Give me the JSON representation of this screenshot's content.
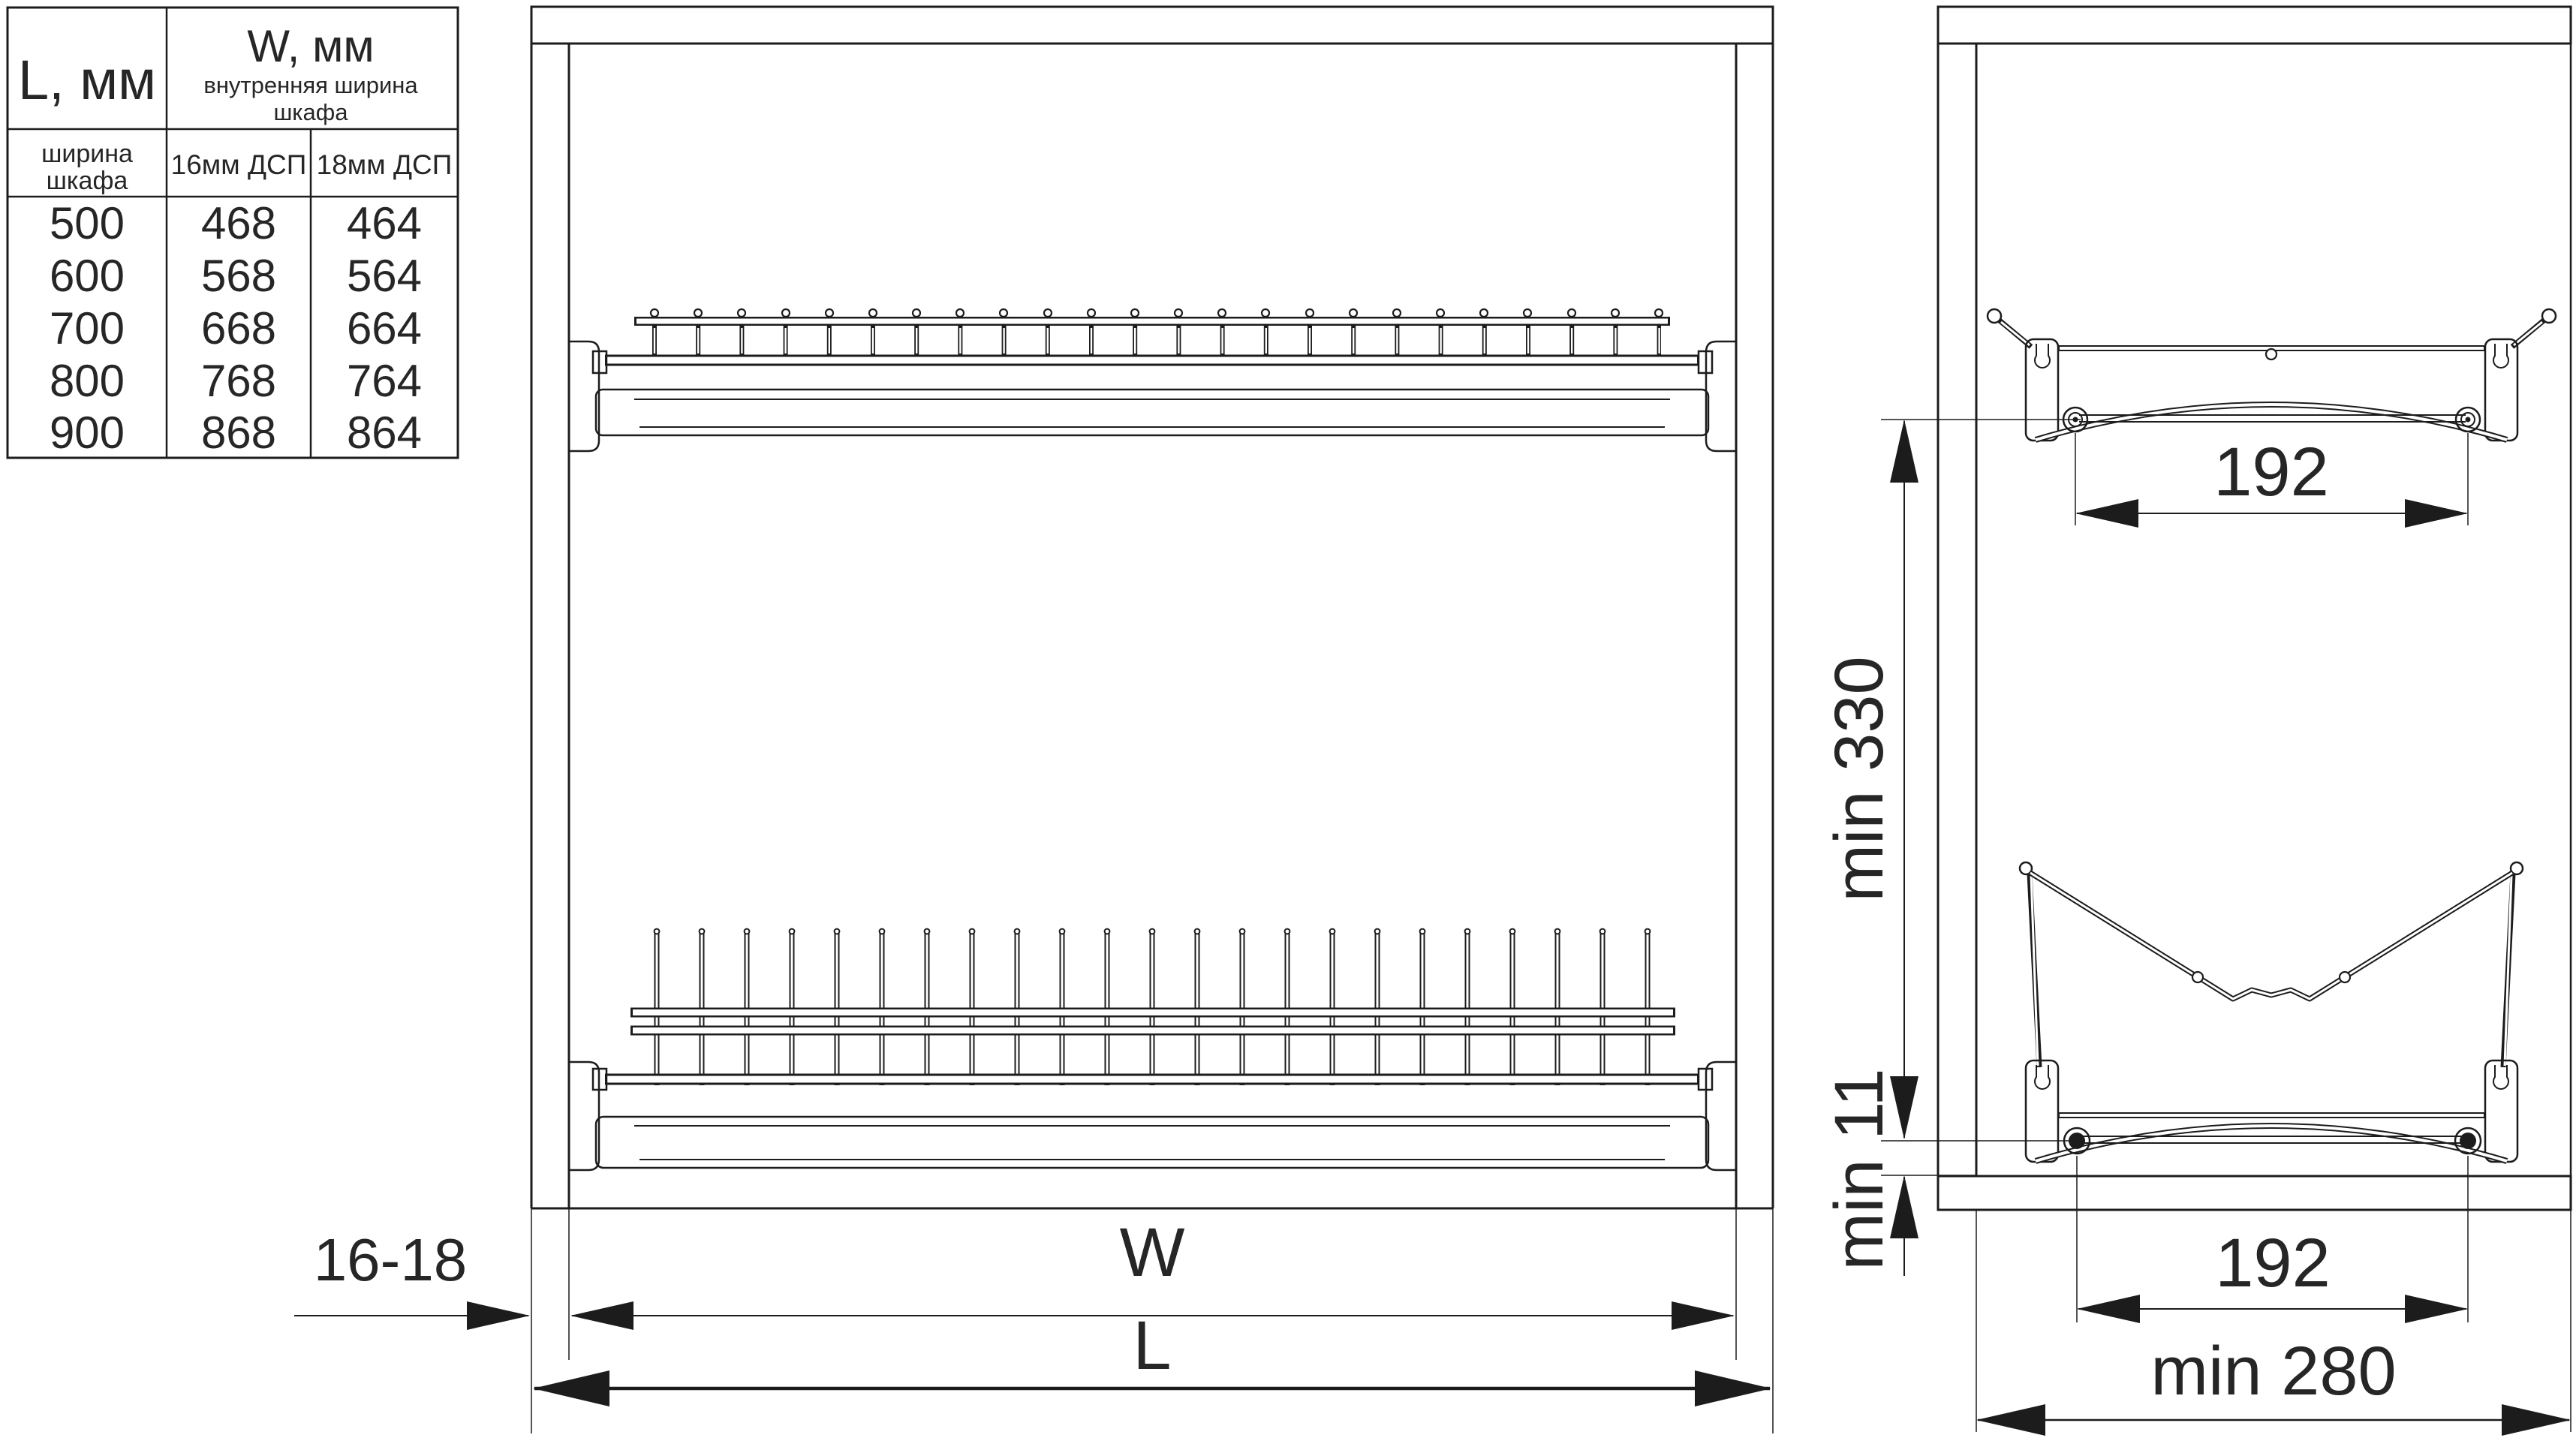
{
  "table": {
    "header": {
      "l_title": "L, мм",
      "w_title": "W, мм",
      "w_sub_line1": "внутренняя ширина",
      "w_sub_line2": "шкафа",
      "l_sub_line1": "ширина",
      "l_sub_line2": "шкафа",
      "col_16": "16мм ДСП",
      "col_18": "18мм ДСП"
    },
    "rows": [
      {
        "l": "500",
        "w16": "468",
        "w18": "464"
      },
      {
        "l": "600",
        "w16": "568",
        "w18": "564"
      },
      {
        "l": "700",
        "w16": "668",
        "w18": "664"
      },
      {
        "l": "800",
        "w16": "768",
        "w18": "764"
      },
      {
        "l": "900",
        "w16": "868",
        "w18": "864"
      }
    ]
  },
  "dims": {
    "panel_thickness": "16-18",
    "inner_width": "W",
    "outer_width": "L",
    "pitch_top": "192",
    "pitch_bottom": "192",
    "min_height": "min 330",
    "min_bottom_clearance": "min 11",
    "min_depth": "min 280"
  }
}
